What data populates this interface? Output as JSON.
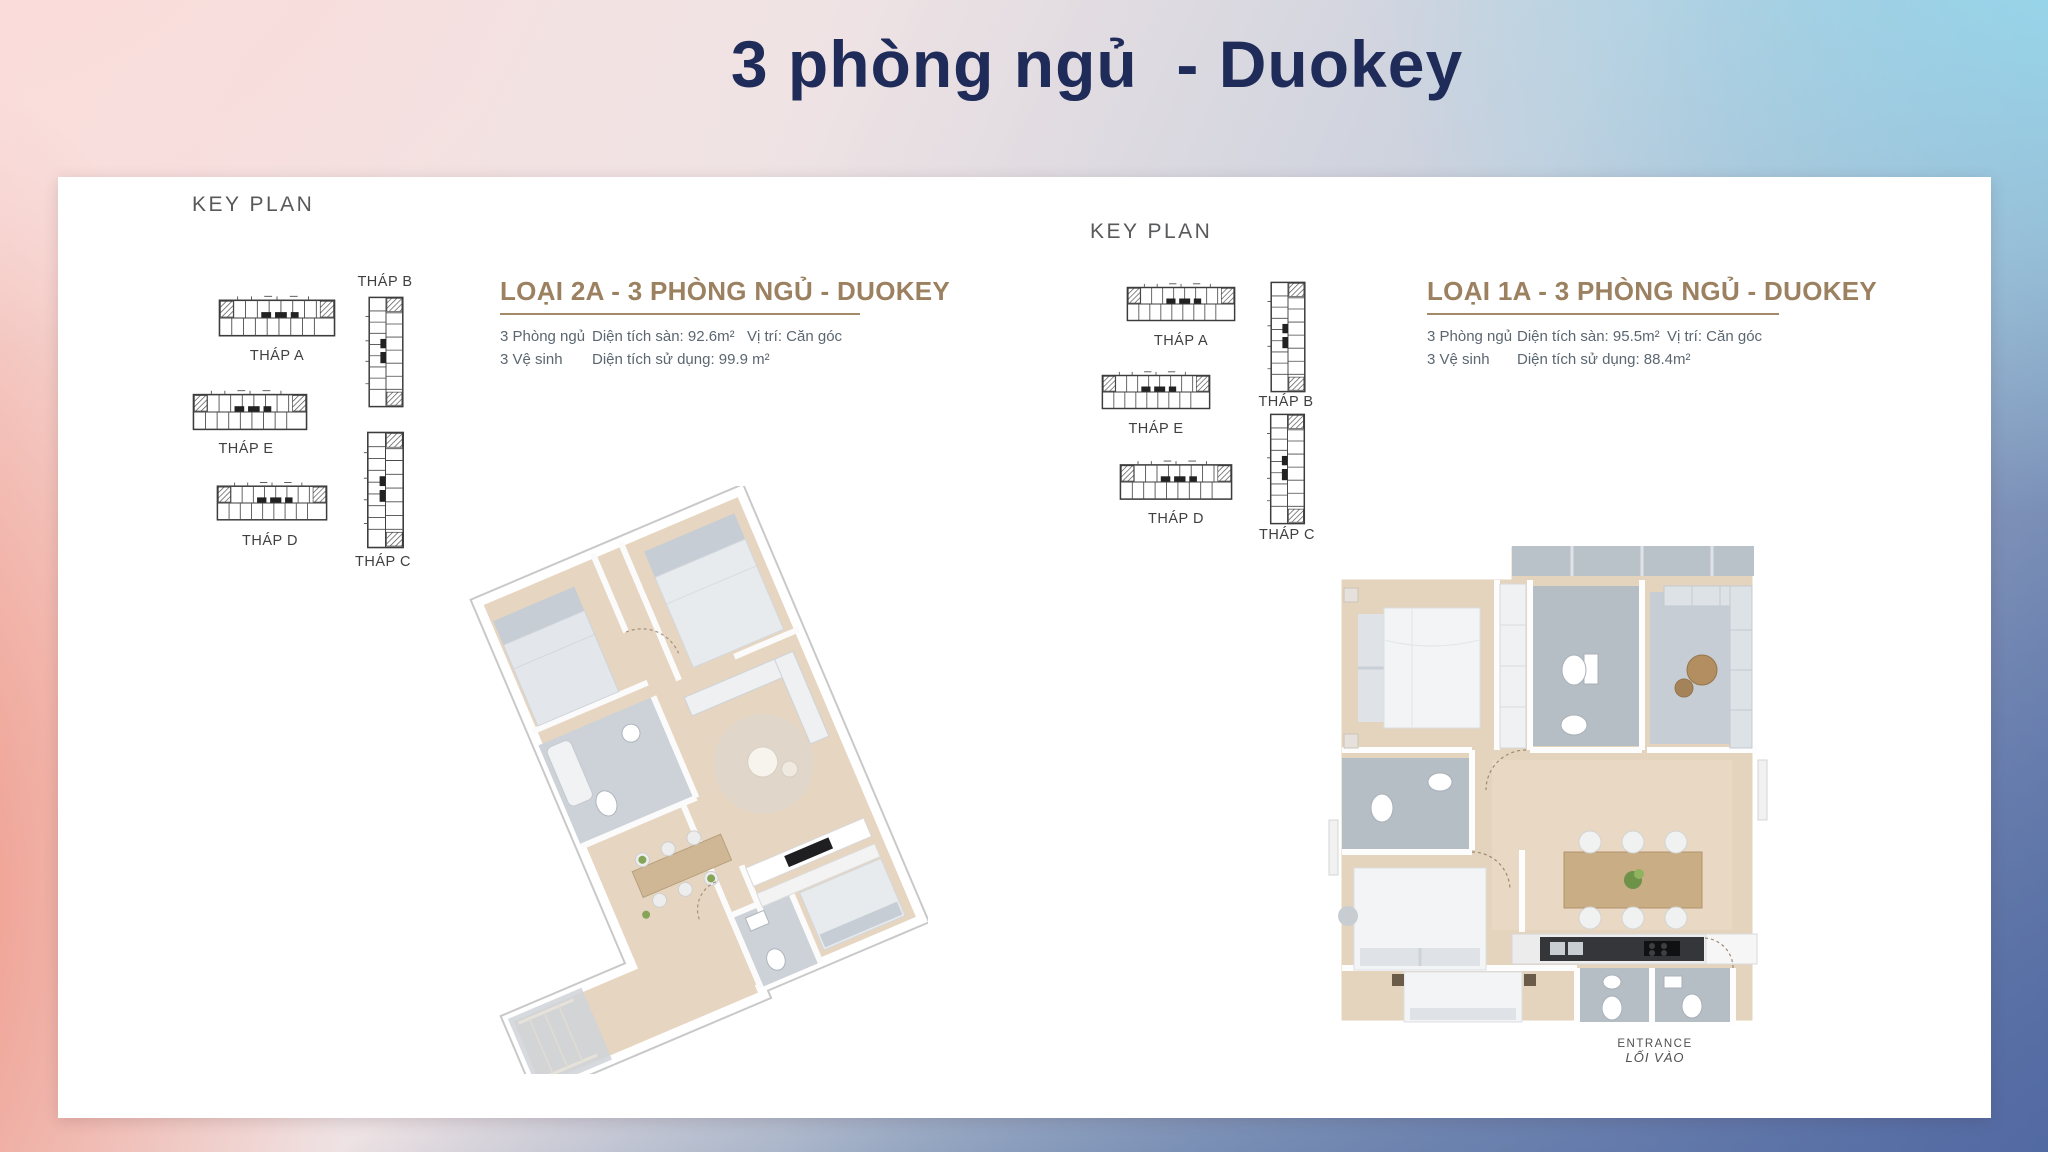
{
  "page_title": "3 phòng ngủ  - Duokey",
  "colors": {
    "title_navy": "#1f2b58",
    "heading_tan": "#9c8161",
    "body_gray": "#5b6670",
    "keyplan_gray": "#58595b",
    "card_white": "#ffffff",
    "gradient_top_left": "#fad9d8",
    "gradient_top_right": "#99d9ec",
    "gradient_bottom_left": "#ec8876",
    "gradient_bottom_right": "#53689e",
    "floor_wood": "#e4d3bd",
    "tile_gray": "#b5bdc5"
  },
  "left_panel": {
    "key_plan_label": "KEY PLAN",
    "heading": "LOẠI 2A - 3 PHÒNG NGỦ - DUOKEY",
    "specs": {
      "bedrooms": "3 Phòng ngủ",
      "bathrooms": "3 Vệ sinh",
      "floor_area": "Diện tích sàn: 92.6m²",
      "usable_area": "Diện tích sử dụng: 99.9 m²",
      "position": "Vị trí: Căn góc"
    },
    "towers": {
      "a": "THÁP A",
      "b": "THÁP B",
      "c": "THÁP C",
      "d": "THÁP D",
      "e": "THÁP E"
    }
  },
  "right_panel": {
    "key_plan_label": "KEY PLAN",
    "heading": "LOẠI 1A - 3 PHÒNG NGỦ - DUOKEY",
    "specs": {
      "bedrooms": "3 Phòng ngủ",
      "bathrooms": "3 Vệ sinh",
      "floor_area": "Diện tích sàn: 95.5m²",
      "usable_area": "Diện tích sử dụng: 88.4m²",
      "position": "Vị trí: Căn góc"
    },
    "towers": {
      "a": "THÁP A",
      "b": "THÁP B",
      "c": "THÁP C",
      "d": "THÁP D",
      "e": "THÁP E"
    },
    "entrance_line1": "ENTRANCE",
    "entrance_line2": "LỐI VÀO"
  }
}
